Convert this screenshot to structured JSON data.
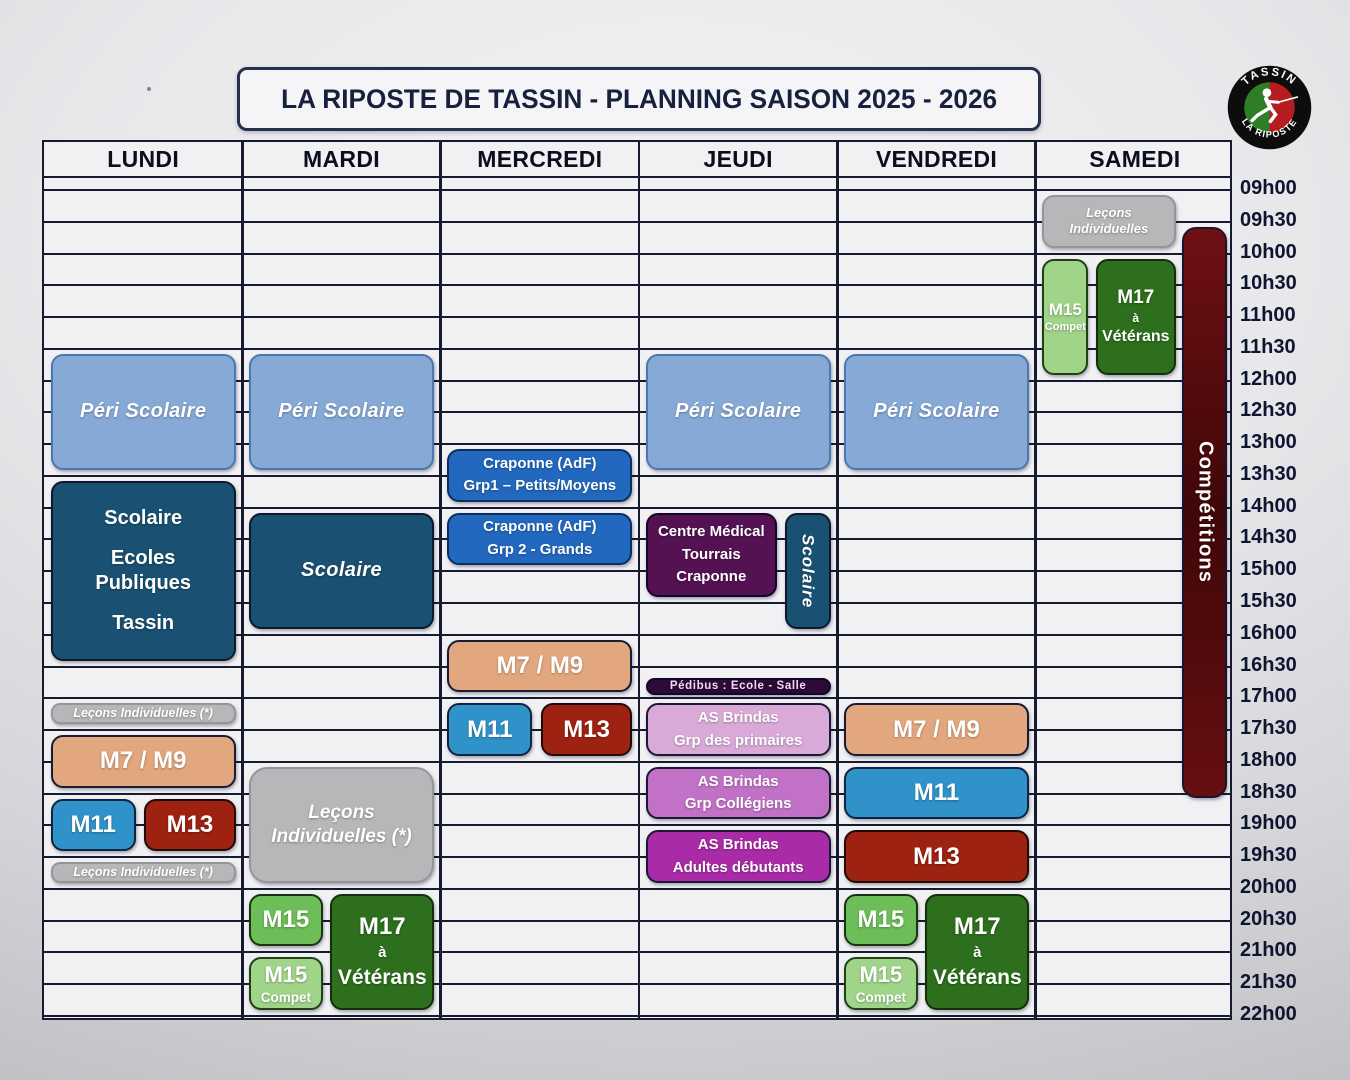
{
  "title": "LA RIPOSTE DE TASSIN - PLANNING SAISON 2025 - 2026",
  "logo": {
    "top_text": "TASSIN",
    "bottom_text": "LA RIPOSTE"
  },
  "days": [
    "LUNDI",
    "MARDI",
    "MERCREDI",
    "JEUDI",
    "VENDREDI",
    "SAMEDI"
  ],
  "times": [
    "09h00",
    "09h30",
    "10h00",
    "10h30",
    "11h00",
    "11h30",
    "12h00",
    "12h30",
    "13h00",
    "13h30",
    "14h00",
    "14h30",
    "15h00",
    "15h30",
    "16h00",
    "16h30",
    "17h00",
    "17h30",
    "18h00",
    "18h30",
    "19h00",
    "19h30",
    "20h00",
    "20h30",
    "21h00",
    "21h30",
    "22h00"
  ],
  "colors": {
    "periscolaire": {
      "bg": "#86a9d6",
      "border": "#4a78b0"
    },
    "scolaire": {
      "bg": "#1a5172",
      "border": "#0c1a2e"
    },
    "craponne": {
      "bg": "#2268be",
      "border": "#0d2f60"
    },
    "medical": {
      "bg": "#541253",
      "border": "#140629"
    },
    "pedibus": {
      "bg": "#2d0a38",
      "border": "#120720"
    },
    "brindas_primaires": {
      "bg": "#d9aad8",
      "border": "#1b1736"
    },
    "brindas_collegiens": {
      "bg": "#c172c6",
      "border": "#1b1736"
    },
    "brindas_adultes": {
      "bg": "#a92ba7",
      "border": "#1b1736"
    },
    "m7m9": {
      "bg": "#e2a77e",
      "border": "#181c32"
    },
    "m11": {
      "bg": "#2f92c8",
      "border": "#0f2440"
    },
    "m13": {
      "bg": "#9d2211",
      "border": "#230b05"
    },
    "m15": {
      "bg": "#6dbd58",
      "border": "#1a3413"
    },
    "m15_compet": {
      "bg": "#9fd489",
      "border": "#204017"
    },
    "m17": {
      "bg": "#2d6f1c",
      "border": "#13300b"
    },
    "lecons": {
      "bg": "#b7b7ba",
      "border": "#95959a"
    },
    "competitions": {
      "bg": "#6e1014",
      "bg2": "#400708",
      "border": "#1d1230"
    }
  },
  "events": [
    {
      "day": 0,
      "start": "11h30",
      "end": "13h30",
      "lines": [
        "Péri Scolaire"
      ],
      "color": "periscolaire",
      "variant": "md italic"
    },
    {
      "day": 0,
      "start": "13h30",
      "end": "16h30",
      "lines": [
        "Scolaire",
        "Ecoles",
        "Publiques",
        "Tassin"
      ],
      "color": "scolaire",
      "variant": "school"
    },
    {
      "day": 0,
      "start": "17h00",
      "end": "17h30",
      "lines": [
        "Leçons Individuelles (*)"
      ],
      "color": "lecons",
      "variant": "strip"
    },
    {
      "day": 0,
      "start": "17h30",
      "end": "18h30",
      "lines": [
        "M7 / M9"
      ],
      "color": "m7m9",
      "variant": "lg"
    },
    {
      "day": 0,
      "start": "18h30",
      "end": "19h30",
      "x": 0,
      "w": 0.46,
      "lines": [
        "M11"
      ],
      "color": "m11",
      "variant": "lg"
    },
    {
      "day": 0,
      "start": "18h30",
      "end": "19h30",
      "x": 0.505,
      "w": 0.495,
      "lines": [
        "M13"
      ],
      "color": "m13",
      "variant": "lg"
    },
    {
      "day": 0,
      "start": "19h30",
      "end": "20h00",
      "lines": [
        "Leçons Individuelles (*)"
      ],
      "color": "lecons",
      "variant": "strip"
    },
    {
      "day": 1,
      "start": "11h30",
      "end": "13h30",
      "lines": [
        "Péri Scolaire"
      ],
      "color": "periscolaire",
      "variant": "md italic"
    },
    {
      "day": 1,
      "start": "14h00",
      "end": "16h00",
      "lines": [
        "Scolaire"
      ],
      "color": "scolaire",
      "variant": "md italic"
    },
    {
      "day": 1,
      "start": "18h00",
      "end": "20h00",
      "lines": [
        "Leçons",
        "Individuelles (*)"
      ],
      "color": "lecons",
      "variant": "lecons-big"
    },
    {
      "day": 1,
      "start": "20h00",
      "end": "21h00",
      "x": 0,
      "w": 0.4,
      "lines": [
        "M15"
      ],
      "color": "m15",
      "variant": "lg"
    },
    {
      "day": 1,
      "start": "21h00",
      "end": "22h00",
      "x": 0,
      "w": 0.4,
      "lines": [
        "M15",
        "Compet"
      ],
      "color": "m15_compet",
      "variant": "compet"
    },
    {
      "day": 1,
      "start": "20h00",
      "end": "22h00",
      "x": 0.44,
      "w": 0.56,
      "lines": [
        "M17",
        "à",
        "Vétérans"
      ],
      "color": "m17",
      "variant": "m17"
    },
    {
      "day": 2,
      "start": "13h00",
      "end": "14h00",
      "lines": [
        "Craponne (AdF)",
        "Grp1 – Petits/Moyens"
      ],
      "color": "craponne",
      "variant": "sm"
    },
    {
      "day": 2,
      "start": "14h00",
      "end": "15h00",
      "lines": [
        "Craponne (AdF)",
        "Grp 2 - Grands"
      ],
      "color": "craponne",
      "variant": "sm"
    },
    {
      "day": 2,
      "start": "16h00",
      "end": "17h00",
      "lines": [
        "M7 / M9"
      ],
      "color": "m7m9",
      "variant": "lg"
    },
    {
      "day": 2,
      "start": "17h00",
      "end": "18h00",
      "x": 0,
      "w": 0.46,
      "lines": [
        "M11"
      ],
      "color": "m11",
      "variant": "lg"
    },
    {
      "day": 2,
      "start": "17h00",
      "end": "18h00",
      "x": 0.505,
      "w": 0.495,
      "lines": [
        "M13"
      ],
      "color": "m13",
      "variant": "lg"
    },
    {
      "day": 3,
      "start": "11h30",
      "end": "13h30",
      "lines": [
        "Péri Scolaire"
      ],
      "color": "periscolaire",
      "variant": "md italic"
    },
    {
      "day": 3,
      "start": "14h00",
      "end": "15h30",
      "x": 0,
      "w": 0.71,
      "lines": [
        "Centre Médical",
        "Tourrais",
        "Craponne"
      ],
      "color": "medical",
      "variant": "sm"
    },
    {
      "day": 3,
      "start": "14h00",
      "end": "16h00",
      "x": 0.75,
      "w": 0.25,
      "lines": [
        "Scolaire"
      ],
      "color": "scolaire",
      "variant": "vertical italic"
    },
    {
      "day": 3,
      "start": "16h30",
      "end": "17h00",
      "lines": [
        "Pédibus : Ecole - Salle"
      ],
      "color": "pedibus",
      "variant": "xs",
      "inset_top": 11,
      "inset_bottom": 3
    },
    {
      "day": 3,
      "start": "17h00",
      "end": "18h00",
      "lines": [
        "AS Brindas",
        "Grp des primaires"
      ],
      "color": "brindas_primaires",
      "variant": "sm"
    },
    {
      "day": 3,
      "start": "18h00",
      "end": "19h00",
      "lines": [
        "AS Brindas",
        "Grp Collégiens"
      ],
      "color": "brindas_collegiens",
      "variant": "sm"
    },
    {
      "day": 3,
      "start": "19h00",
      "end": "20h00",
      "lines": [
        "AS Brindas",
        "Adultes débutants"
      ],
      "color": "brindas_adultes",
      "variant": "sm"
    },
    {
      "day": 4,
      "start": "11h30",
      "end": "13h30",
      "lines": [
        "Péri Scolaire"
      ],
      "color": "periscolaire",
      "variant": "md italic"
    },
    {
      "day": 4,
      "start": "17h00",
      "end": "18h00",
      "lines": [
        "M7 / M9"
      ],
      "color": "m7m9",
      "variant": "lg"
    },
    {
      "day": 4,
      "start": "18h00",
      "end": "19h00",
      "lines": [
        "M11"
      ],
      "color": "m11",
      "variant": "lg"
    },
    {
      "day": 4,
      "start": "19h00",
      "end": "20h00",
      "lines": [
        "M13"
      ],
      "color": "m13",
      "variant": "lg"
    },
    {
      "day": 4,
      "start": "20h00",
      "end": "21h00",
      "x": 0,
      "w": 0.4,
      "lines": [
        "M15"
      ],
      "color": "m15",
      "variant": "lg"
    },
    {
      "day": 4,
      "start": "21h00",
      "end": "22h00",
      "x": 0,
      "w": 0.4,
      "lines": [
        "M15",
        "Compet"
      ],
      "color": "m15_compet",
      "variant": "compet"
    },
    {
      "day": 4,
      "start": "20h00",
      "end": "22h00",
      "x": 0.44,
      "w": 0.56,
      "lines": [
        "M17",
        "à",
        "Vétérans"
      ],
      "color": "m17",
      "variant": "m17"
    },
    {
      "day": 5,
      "start": "09h00",
      "end": "10h00",
      "x": 0,
      "w": 0.72,
      "lines": [
        "Leçons",
        "Individuelles"
      ],
      "color": "lecons",
      "variant": "lecons-sm"
    },
    {
      "day": 5,
      "start": "10h00",
      "end": "12h00",
      "x": 0,
      "w": 0.25,
      "lines": [
        "M15",
        "Compet"
      ],
      "color": "m15_compet",
      "variant": "compet narrow"
    },
    {
      "day": 5,
      "start": "10h00",
      "end": "12h00",
      "x": 0.29,
      "w": 0.43,
      "lines": [
        "M17",
        "à",
        "Vétérans"
      ],
      "color": "m17",
      "variant": "m17 narrow"
    },
    {
      "day": 5,
      "start": "09h30",
      "end": "18h30",
      "x": 0.755,
      "w": 0.245,
      "lines": [
        "Compétitions"
      ],
      "color": "competitions",
      "variant": "comp",
      "inset_bottom": -4
    }
  ]
}
